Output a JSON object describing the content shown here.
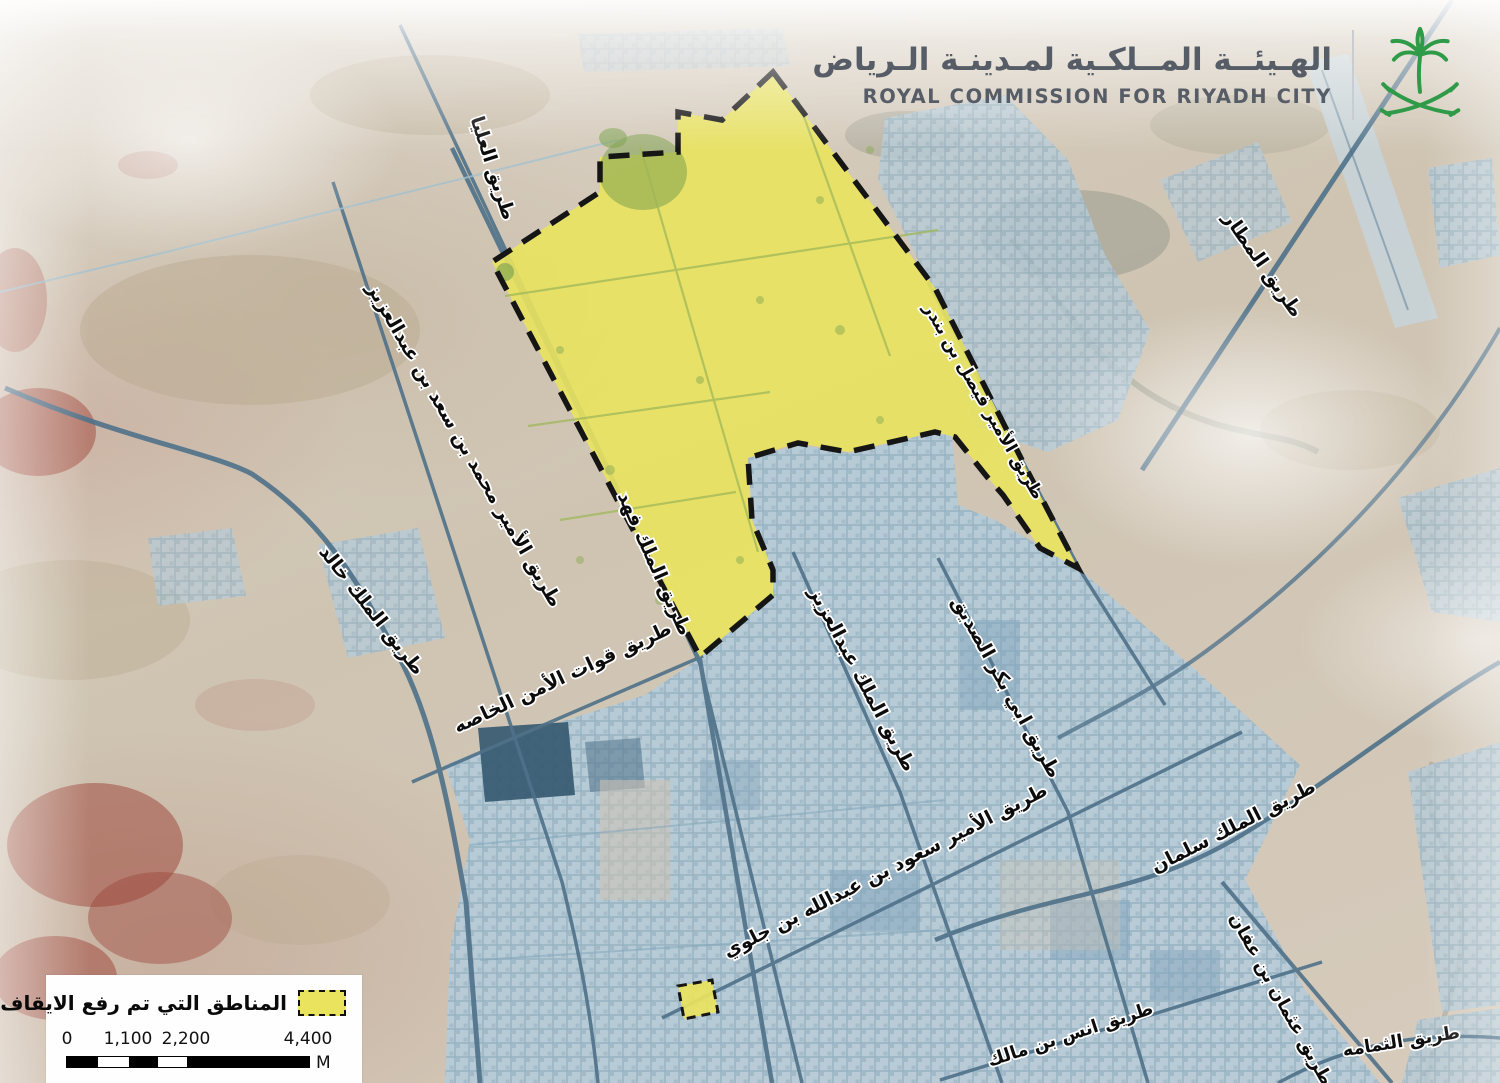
{
  "header": {
    "title_ar": "الهـيئــة المــلكـية لمـدينـة الـرياض",
    "title_en": "ROYAL COMMISSION FOR RIYADH CITY"
  },
  "legend": {
    "label_ar": "المناطق التي تم رفع الايقاف عنها"
  },
  "scale_bar": {
    "ticks": [
      "0",
      "1,100",
      "2,200",
      "4,400"
    ],
    "unit": "M"
  },
  "map": {
    "road_labels": [
      {
        "id": "olaya-road",
        "text": "طريق العليا",
        "x": 487,
        "y": 170,
        "rotate": 72,
        "size": 19
      },
      {
        "id": "prince-mohammed-bin-saad-bin-abdulaziz-road",
        "text": "طريق الأمير محمد بن سعد بن عبدالعزيز",
        "x": 459,
        "y": 448,
        "rotate": 60,
        "size": 19
      },
      {
        "id": "king-khalid-road",
        "text": "طريق الملك خالد",
        "x": 367,
        "y": 614,
        "rotate": 52,
        "size": 19
      },
      {
        "id": "king-fahd-road",
        "text": "طريق الملك فهد",
        "x": 649,
        "y": 566,
        "rotate": 66,
        "size": 19
      },
      {
        "id": "special-security-forces-road",
        "text": "طريق قوات الأمن الخاصه",
        "x": 565,
        "y": 683,
        "rotate": -25,
        "size": 19
      },
      {
        "id": "king-abdulaziz-road",
        "text": "طريق الملك عبدالعزيز",
        "x": 857,
        "y": 682,
        "rotate": 62,
        "size": 19
      },
      {
        "id": "abu-bakr-al-siddiq-road",
        "text": "طريق ابي بكر الصديق",
        "x": 1001,
        "y": 690,
        "rotate": 61,
        "size": 19
      },
      {
        "id": "prince-faisal-bin-bandar-road",
        "text": "طريق الأمير فيصل بن بندر",
        "x": 979,
        "y": 404,
        "rotate": 60,
        "size": 17
      },
      {
        "id": "airport-road",
        "text": "طريق المطار",
        "x": 1258,
        "y": 268,
        "rotate": 55,
        "size": 19
      },
      {
        "id": "prince-saud-bin-abdullah-bin-jalawi-road",
        "text": "طريق الأمير سعود بن عبدالله بن جلوي",
        "x": 888,
        "y": 876,
        "rotate": -27,
        "size": 19
      },
      {
        "id": "king-salman-road",
        "text": "طريق الملك سلمان",
        "x": 1236,
        "y": 832,
        "rotate": -27,
        "size": 19
      },
      {
        "id": "othman-bin-affan-road",
        "text": "طريق عثمان بن عفان",
        "x": 1276,
        "y": 1002,
        "rotate": 61,
        "size": 18
      },
      {
        "id": "anas-bin-malik-road",
        "text": "طريق انس بن مالك",
        "x": 1072,
        "y": 1040,
        "rotate": -18,
        "size": 18
      },
      {
        "id": "al-thumamah-road",
        "text": "طريق الثمامه",
        "x": 1402,
        "y": 1047,
        "rotate": -9,
        "size": 18
      }
    ]
  },
  "colors": {
    "emblem_green": "#2f9b48",
    "header_text": "#575d66",
    "highlight_yellow": "#e9e35e",
    "legend_swatch_yellow": "#f2ee86",
    "boundary_black": "#151515",
    "city_blue": "#b6cbd8",
    "desert_tan": "#cfc4b2"
  }
}
